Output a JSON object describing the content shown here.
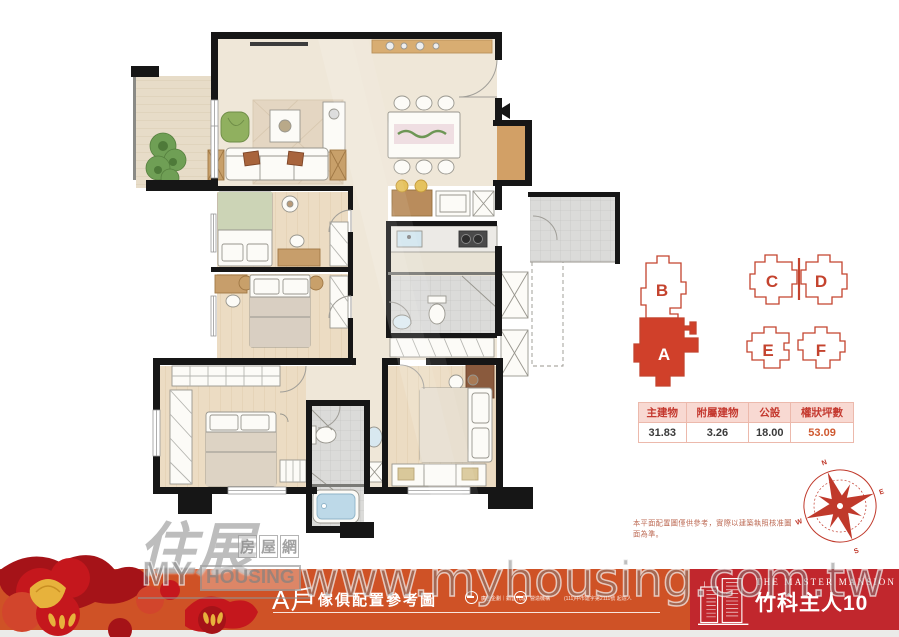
{
  "unit_key": {
    "selected_unit": "A",
    "units": [
      {
        "id": "B",
        "label": "B",
        "selected": false
      },
      {
        "id": "A",
        "label": "A",
        "selected": true
      },
      {
        "id": "C",
        "label": "C",
        "selected": false
      },
      {
        "id": "D",
        "label": "D",
        "selected": false
      },
      {
        "id": "E",
        "label": "E",
        "selected": false
      },
      {
        "id": "F",
        "label": "F",
        "selected": false
      }
    ]
  },
  "area_table": {
    "headers": [
      "主建物",
      "附屬建物",
      "公設",
      "權狀坪數"
    ],
    "values": [
      "31.83",
      "3.26",
      "18.00",
      "53.09"
    ]
  },
  "compass": {
    "north": "N",
    "east": "E",
    "south": "S",
    "west": "W"
  },
  "disclaimer": "本平面配置圖僅供參考，實際以建築執照核准圖面為準。",
  "banner": {
    "unit_label": "A戶",
    "subtitle": "傢俱配置參考圖",
    "logo1_label": "廣告企劃｜銷售代理",
    "logo2_label": "營造機構",
    "fine_print": "(111)中市建字第2111號 起造人"
  },
  "brand": {
    "name_en": "THE MASTER MANSION",
    "name_zh": "竹科主人10"
  },
  "watermark": {
    "site": "www.myhousing.com.tw",
    "logo_zh": "住展",
    "logo_tag": [
      "房",
      "屋",
      "網"
    ],
    "logo_en_strong": "MY",
    "logo_en_box": "HOUSING"
  },
  "colors": {
    "band": "#cf5226",
    "brand_panel": "#c1272d",
    "accent_red": "#c4432e",
    "unit_fill": "#d0402a",
    "table_header_bg": "#f8d9d2",
    "highlight_value": "#cf5a31",
    "flower_red": "#c5171d",
    "flower_gold": "#e7b23c",
    "wall_black": "#161616"
  }
}
